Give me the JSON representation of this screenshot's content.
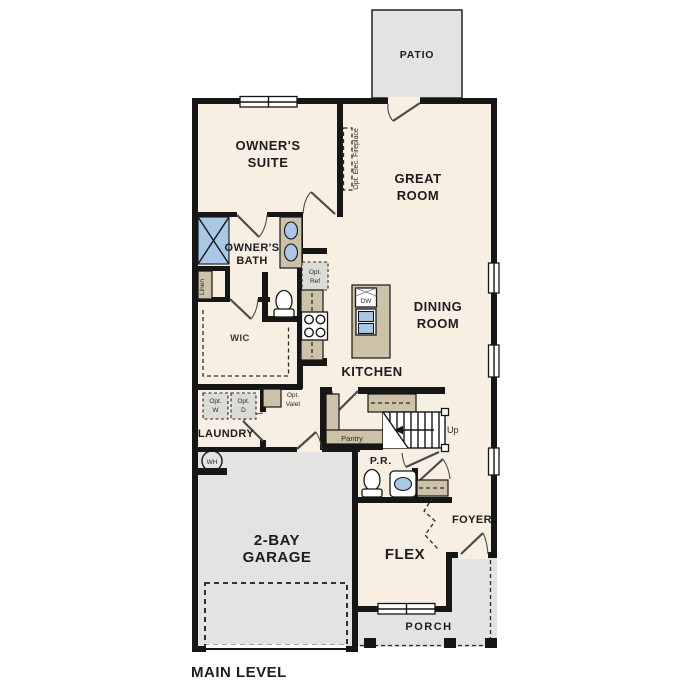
{
  "title": "MAIN LEVEL",
  "labels": {
    "main_level": "MAIN LEVEL",
    "patio": "PATIO",
    "owners_suite": [
      "OWNER'S",
      "SUITE"
    ],
    "great_room": [
      "GREAT",
      "ROOM"
    ],
    "owners_bath": [
      "OWNER'S",
      "BATH"
    ],
    "dining_room": [
      "DINING",
      "ROOM"
    ],
    "kitchen": "KITCHEN",
    "wic": "WIC",
    "linen": "Linen",
    "fireplace": "Opt. Elec. Fireplace",
    "opt_ref": [
      "Opt.",
      "Ref"
    ],
    "dw": "DW",
    "laundry": "LAUNDRY",
    "opt_w": [
      "Opt.",
      "W"
    ],
    "opt_d": [
      "Opt.",
      "D"
    ],
    "opt_valet": [
      "Opt.",
      "Valet"
    ],
    "pantry": "Pantry",
    "up": "Up",
    "pr": "P.R.",
    "wh": "WH",
    "foyer": "FOYER",
    "flex": "FLEX",
    "garage": [
      "2-BAY",
      "GARAGE"
    ],
    "porch": "PORCH"
  },
  "colors": {
    "background": "#ffffff",
    "floor": "#f6efe2",
    "hardscape_gray": "#e3e3e1",
    "cabinet_tan": "#cdc1a8",
    "fixture_blue": "#a9c7e6",
    "optional_gray": "#dcdcd6",
    "wall_black": "#161616"
  }
}
